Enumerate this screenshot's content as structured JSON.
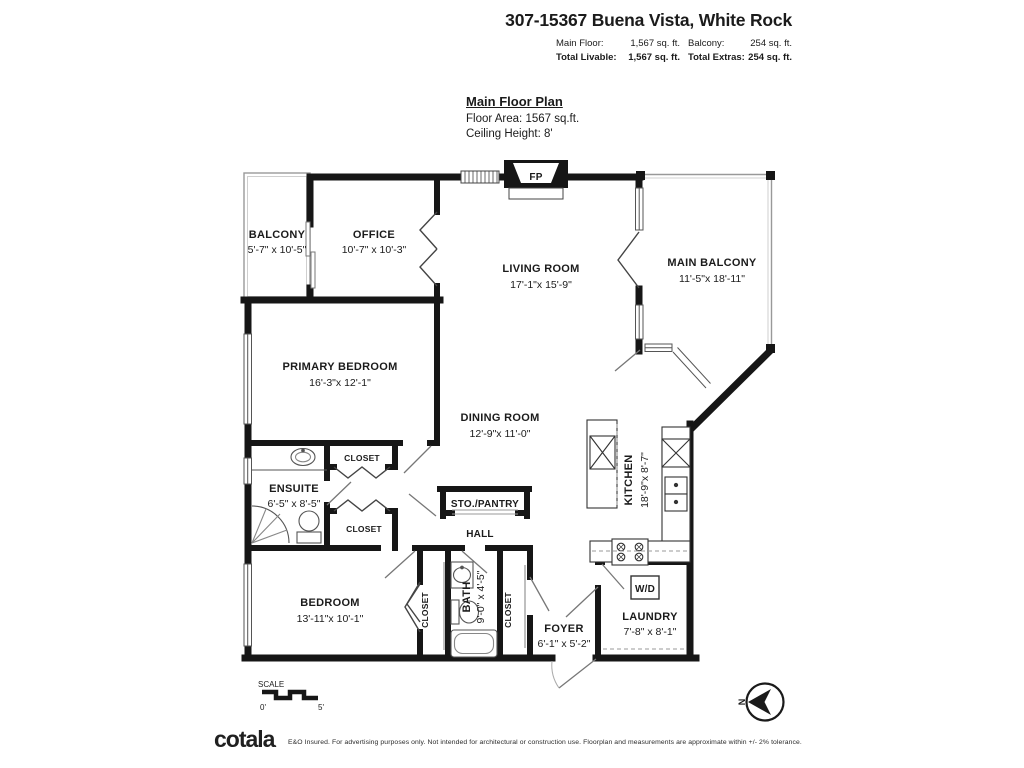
{
  "header": {
    "title": "307-15367 Buena Vista, White Rock",
    "main_floor_label": "Main Floor:",
    "main_floor_value": "1,567 sq. ft.",
    "balcony_label": "Balcony:",
    "balcony_value": "254 sq. ft.",
    "total_livable_label": "Total Livable:",
    "total_livable_value": "1,567 sq. ft.",
    "total_extras_label": "Total Extras:",
    "total_extras_value": "254 sq. ft."
  },
  "plan_info": {
    "title": "Main Floor Plan",
    "floor_area": "Floor Area: 1567 sq.ft.",
    "ceiling_height": "Ceiling Height: 8'"
  },
  "rooms": {
    "balcony": {
      "name": "BALCONY",
      "dims": "5'-7\" x 10'-5\""
    },
    "office": {
      "name": "OFFICE",
      "dims": "10'-7\" x 10'-3\""
    },
    "living_room": {
      "name": "LIVING ROOM",
      "dims": "17'-1\"x 15'-9\""
    },
    "main_balcony": {
      "name": "MAIN BALCONY",
      "dims": "11'-5\"x 18'-11\""
    },
    "primary_bedroom": {
      "name": "PRIMARY BEDROOM",
      "dims": "16'-3\"x 12'-1\""
    },
    "dining_room": {
      "name": "DINING ROOM",
      "dims": "12'-9\"x 11'-0\""
    },
    "kitchen": {
      "name": "KITCHEN",
      "dims": "18'-9\"x 8'-7\""
    },
    "ensuite": {
      "name": "ENSUITE",
      "dims": "6'-5\" x 8'-5\""
    },
    "closet_top": {
      "name": "CLOSET"
    },
    "closet_bottom": {
      "name": "CLOSET"
    },
    "sto_pantry": {
      "name": "STO./PANTRY"
    },
    "hall": {
      "name": "HALL"
    },
    "bedroom": {
      "name": "BEDROOM",
      "dims": "13'-11\"x 10'-1\""
    },
    "closet_left": {
      "name": "CLOSET"
    },
    "bath": {
      "name": "BATH",
      "dims": "9'-0\" x 4'-5\""
    },
    "closet_right": {
      "name": "CLOSET"
    },
    "foyer": {
      "name": "FOYER",
      "dims": "6'-1\" x 5'-2\""
    },
    "laundry": {
      "name": "LAUNDRY",
      "dims": "7'-8\" x 8'-1\""
    },
    "washer_dryer": "W/D",
    "fireplace": "FP"
  },
  "scale": {
    "label": "SCALE",
    "start": "0'",
    "end": "5'"
  },
  "compass": {
    "north": "N"
  },
  "footer": {
    "brand": "cotala",
    "brand_mark": ".",
    "disclaimer": "E&O Insured. For advertising purposes only. Not intended for architectural or construction use. Floorplan and measurements are approximate within +/- 2% tolerance."
  },
  "colors": {
    "wall": "#161616",
    "thin_line": "#999999",
    "text": "#1b1b1b"
  }
}
